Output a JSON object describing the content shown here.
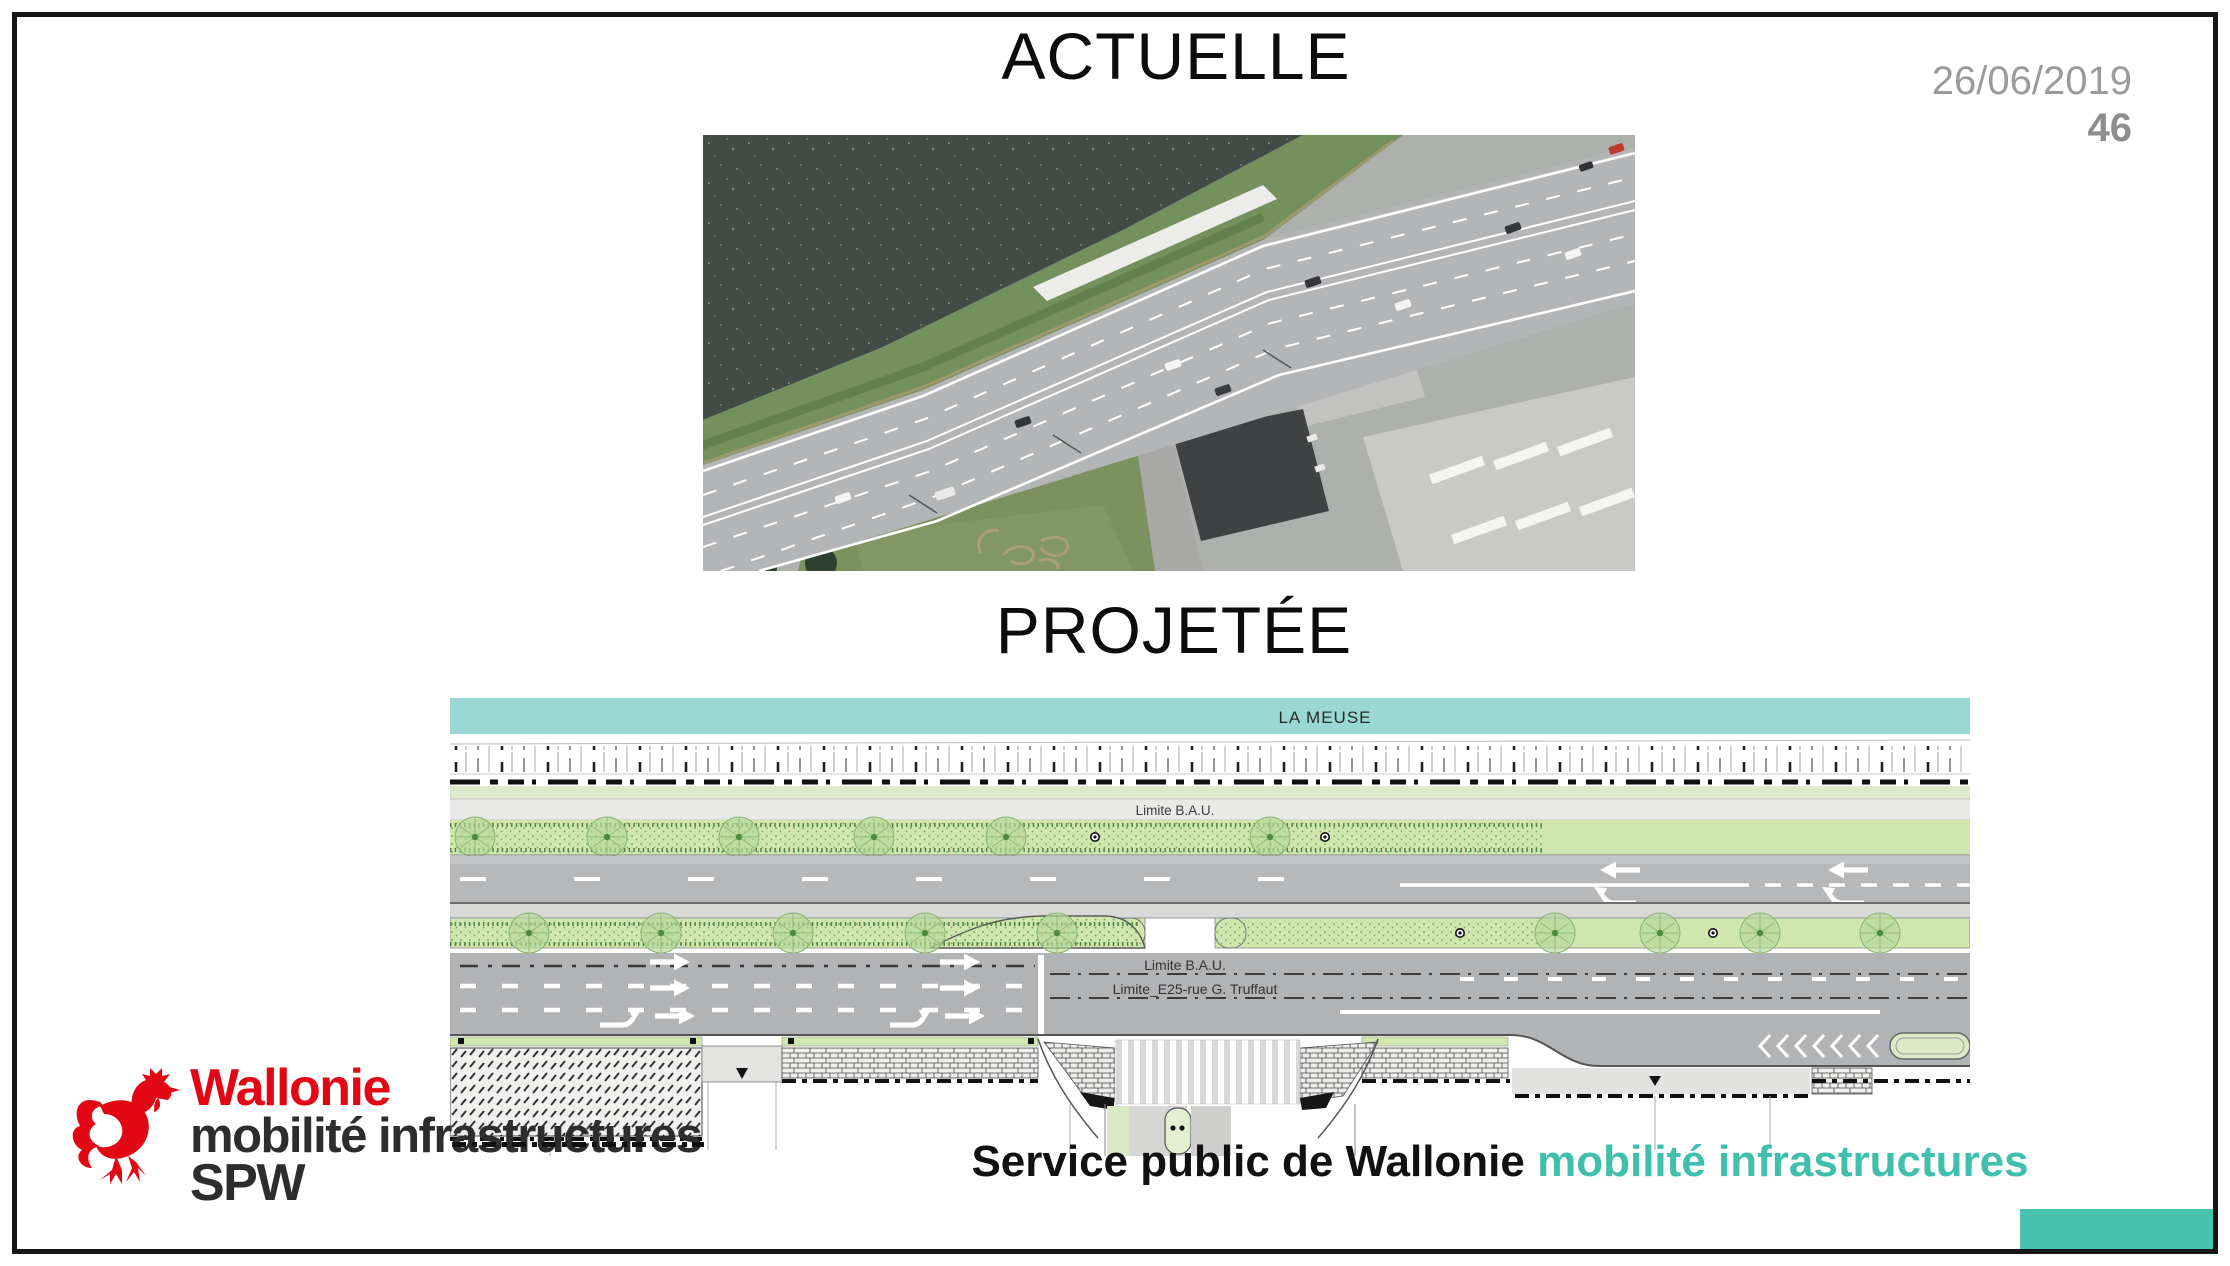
{
  "slide": {
    "date": "26/06/2019",
    "page_number": "46",
    "section_top": {
      "title": "ACTUELLE"
    },
    "section_bottom": {
      "title": "PROJETÉE"
    },
    "plan": {
      "river_label": "LA MEUSE",
      "limit_bau_upper": "Limite B.A.U.",
      "limit_bau_lower": "Limite B.A.U.",
      "limit_e25": "Limite_E25-rue G. Truffaut"
    },
    "logo": {
      "line1": "Wallonie",
      "line2": "mobilité infrastructures",
      "line3": "SPW"
    },
    "footer": {
      "text_black": "Service public de Wallonie",
      "text_teal": "mobilité infrastructures"
    },
    "colors": {
      "accent_teal": "#46c2ae",
      "footer_teal": "#3fbfac",
      "river_band_teal": "#9ad8d4",
      "logo_red": "#e30613",
      "date_gray": "#9b9b9b"
    }
  }
}
